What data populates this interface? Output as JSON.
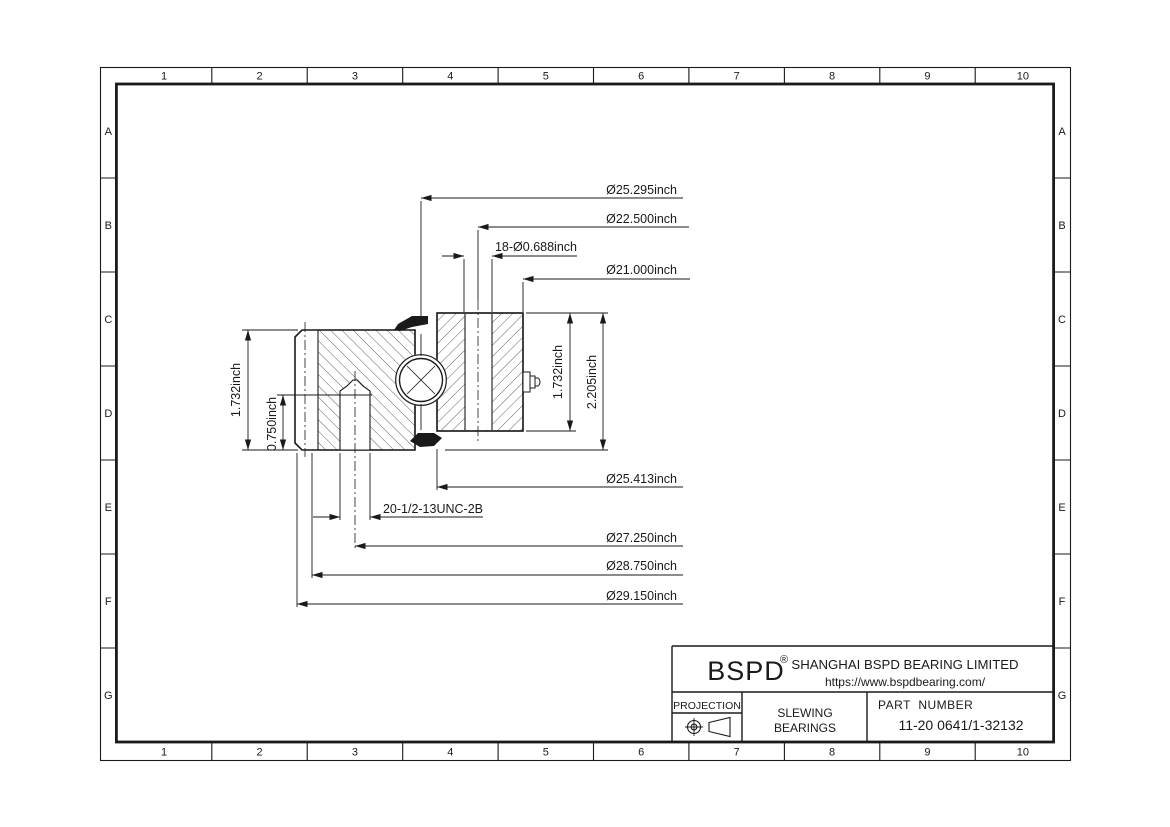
{
  "sheet": {
    "grid_columns": [
      "1",
      "2",
      "3",
      "4",
      "5",
      "6",
      "7",
      "8",
      "9",
      "10"
    ],
    "grid_rows": [
      "A",
      "B",
      "C",
      "D",
      "E",
      "F",
      "G"
    ],
    "ink_color": "#1a1a1a"
  },
  "dimensions": {
    "raceway_diameter": "Ø25.295inch",
    "mount_bolt_circle": "Ø22.500inch",
    "mount_holes": "18-Ø0.688inch",
    "bore_diameter": "Ø21.000inch",
    "inner_ring_od": "Ø25.413inch",
    "tapped_holes": "20-1/2-13UNC-2B",
    "tapped_bolt_circle": "Ø27.250inch",
    "recess_diameter": "Ø28.750inch",
    "outside_diameter": "Ø29.150inch",
    "outer_ring_height": "1.732inch",
    "thread_depth": "0.750inch",
    "inner_ring_height": "1.732inch",
    "overall_height": "2.205inch"
  },
  "title_block": {
    "brand": "BSPD",
    "registered_mark": "®",
    "company": "SHANGHAI BSPD BEARING LIMITED",
    "website": "https://www.bspdbearing.com/",
    "projection_label": "PROJECTION",
    "product_line1": "SLEWING",
    "product_line2": "BEARINGS",
    "part_number_label": "PART  NUMBER",
    "part_number": "11-20 0641/1-32132"
  }
}
